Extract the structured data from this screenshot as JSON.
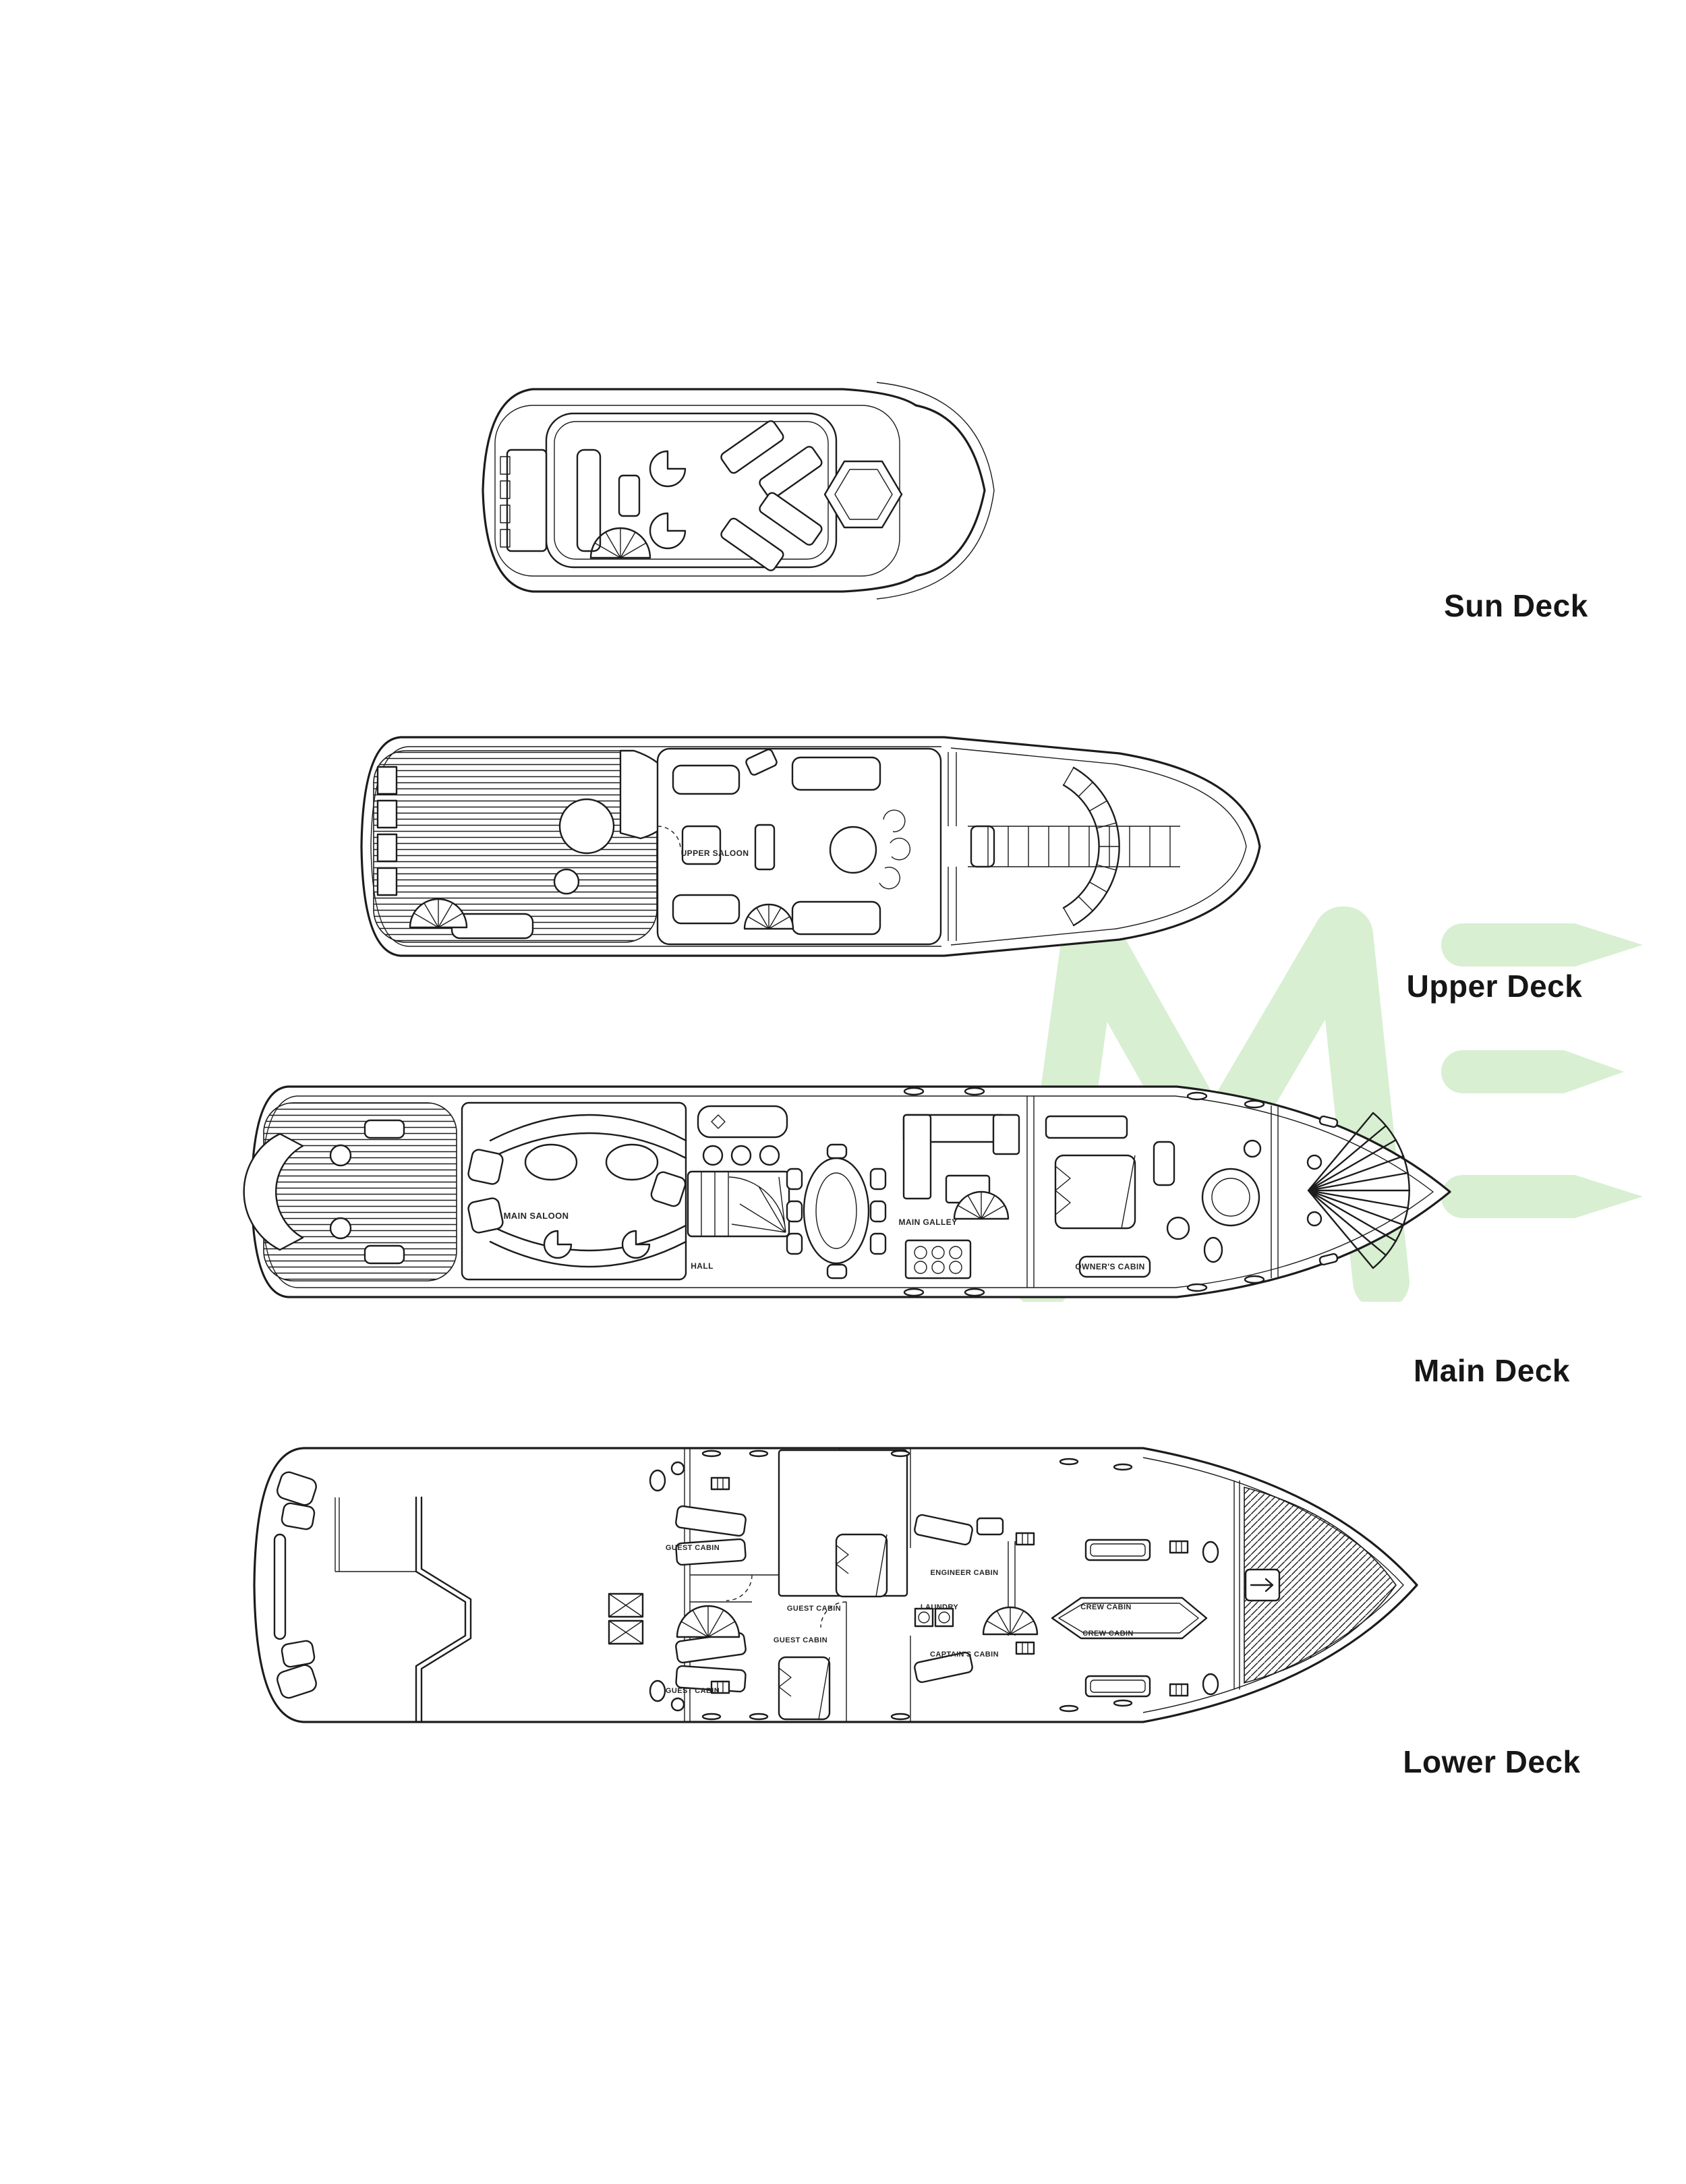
{
  "page": {
    "background": "#ffffff"
  },
  "colors": {
    "line": "#1c1c1c",
    "heading_text": "#161616",
    "room_text": "#262626",
    "watermark_green": "#d8efd2"
  },
  "watermark": {
    "letters": "ME"
  },
  "decks": [
    {
      "id": "sun",
      "label": "Sun Deck",
      "rooms": []
    },
    {
      "id": "upper",
      "label": "Upper Deck",
      "rooms": [
        {
          "label": "UPPER SALOON"
        }
      ]
    },
    {
      "id": "main",
      "label": "Main Deck",
      "rooms": [
        {
          "label": "MAIN SALOON"
        },
        {
          "label": "HALL"
        },
        {
          "label": "MAIN GALLEY"
        },
        {
          "label": "OWNER'S CABIN"
        }
      ]
    },
    {
      "id": "lower",
      "label": "Lower Deck",
      "rooms": [
        {
          "label": "GUEST CABIN"
        },
        {
          "label": "GUEST CABIN"
        },
        {
          "label": "GUEST CABIN"
        },
        {
          "label": "GUEST CABIN"
        },
        {
          "label": "ENGINEER CABIN"
        },
        {
          "label": "LAUNDRY"
        },
        {
          "label": "CAPTAIN'S CABIN"
        },
        {
          "label": "CREW CABIN"
        },
        {
          "label": "CREW CABIN"
        }
      ]
    }
  ]
}
